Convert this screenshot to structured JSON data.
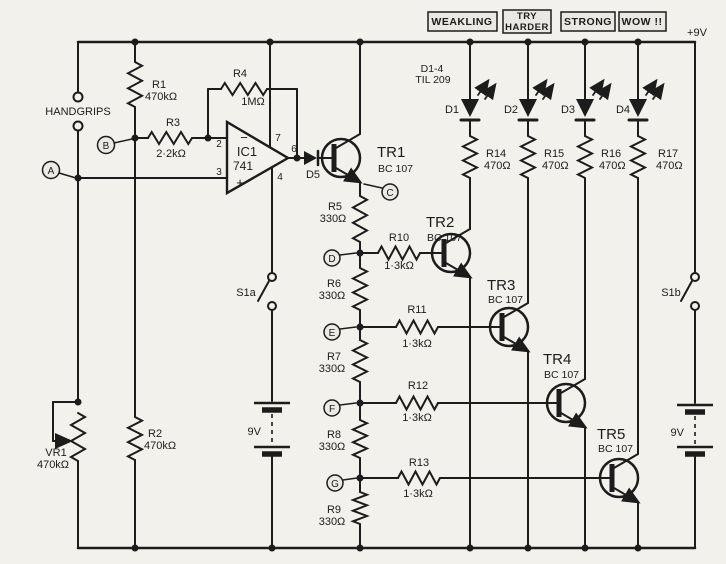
{
  "palette": {
    "paper": "#f2f1ec",
    "ink": "#1c1c1c",
    "shade": "#eae8e2"
  },
  "power": {
    "rail": "+9V",
    "battery_a": "9V",
    "battery_b": "9V",
    "switch_a": "S1a",
    "switch_b": "S1b"
  },
  "banners": [
    {
      "lines": [
        "WEAKLING"
      ]
    },
    {
      "lines": [
        "TRY",
        "HARDER"
      ]
    },
    {
      "lines": [
        "STRONG"
      ]
    },
    {
      "lines": [
        "WOW !!"
      ]
    }
  ],
  "input": {
    "label": "HANDGRIPS"
  },
  "nodes": {
    "a": "A",
    "b": "B",
    "c": "C",
    "d": "D",
    "e": "E",
    "f": "F",
    "g": "G"
  },
  "opamp": {
    "ref": "IC1",
    "type": "741",
    "minus": "−",
    "plus": "+",
    "pin2": "2",
    "pin3": "3",
    "pin4": "4",
    "pin6": "6",
    "pin7": "7"
  },
  "led_note": {
    "l1": "D1-4",
    "l2": "TIL 209"
  },
  "diodes": {
    "d1": "D1",
    "d2": "D2",
    "d3": "D3",
    "d4": "D4",
    "d5": "D5"
  },
  "resistors": {
    "r1": {
      "ref": "R1",
      "val": "470kΩ"
    },
    "r2": {
      "ref": "R2",
      "val": "470kΩ"
    },
    "r3": {
      "ref": "R3",
      "val": "2·2kΩ"
    },
    "r4": {
      "ref": "R4",
      "val": "1MΩ"
    },
    "r5": {
      "ref": "R5",
      "val": "330Ω"
    },
    "r6": {
      "ref": "R6",
      "val": "330Ω"
    },
    "r7": {
      "ref": "R7",
      "val": "330Ω"
    },
    "r8": {
      "ref": "R8",
      "val": "330Ω"
    },
    "r9": {
      "ref": "R9",
      "val": "330Ω"
    },
    "r10": {
      "ref": "R10",
      "val": "1·3kΩ"
    },
    "r11": {
      "ref": "R11",
      "val": "1·3kΩ"
    },
    "r12": {
      "ref": "R12",
      "val": "1·3kΩ"
    },
    "r13": {
      "ref": "R13",
      "val": "1·3kΩ"
    },
    "r14": {
      "ref": "R14",
      "val": "470Ω"
    },
    "r15": {
      "ref": "R15",
      "val": "470Ω"
    },
    "r16": {
      "ref": "R16",
      "val": "470Ω"
    },
    "r17": {
      "ref": "R17",
      "val": "470Ω"
    },
    "vr1": {
      "ref": "VR1",
      "val": "470kΩ"
    }
  },
  "transistors": {
    "tr1": {
      "ref": "TR1",
      "part": "BC 107"
    },
    "tr2": {
      "ref": "TR2",
      "part": "BC 107"
    },
    "tr3": {
      "ref": "TR3",
      "part": "BC 107"
    },
    "tr4": {
      "ref": "TR4",
      "part": "BC 107"
    },
    "tr5": {
      "ref": "TR5",
      "part": "BC 107"
    }
  }
}
